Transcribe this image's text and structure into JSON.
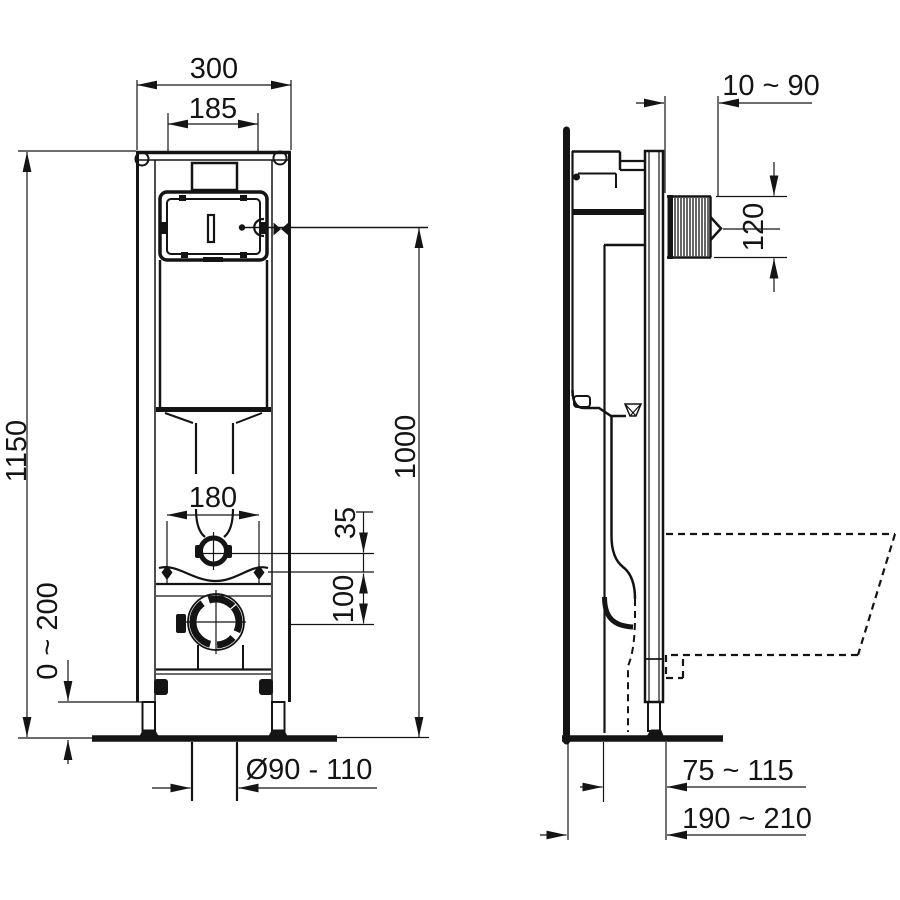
{
  "meta": {
    "background": "#ffffff",
    "line_color": "#141414",
    "drawing_type": "wc-frame-installation-drawing"
  },
  "front_view": {
    "dims": {
      "overall_width": "300",
      "cistern_width": "185",
      "overall_height": "1150",
      "leg_adjustment": "0 ~ 200",
      "fixing_bolt_spacing": "180",
      "flush_pipe_offset": "35",
      "outlet_offset": "100",
      "actuator_height": "1000",
      "outlet_diameter": "Ø90 - 110"
    }
  },
  "side_view": {
    "dims": {
      "wall_adjustment": "10 ~ 90",
      "actuator_opening_height": "120",
      "outlet_depth": "75 ~ 115",
      "drain_depth": "190 ~ 210"
    }
  }
}
